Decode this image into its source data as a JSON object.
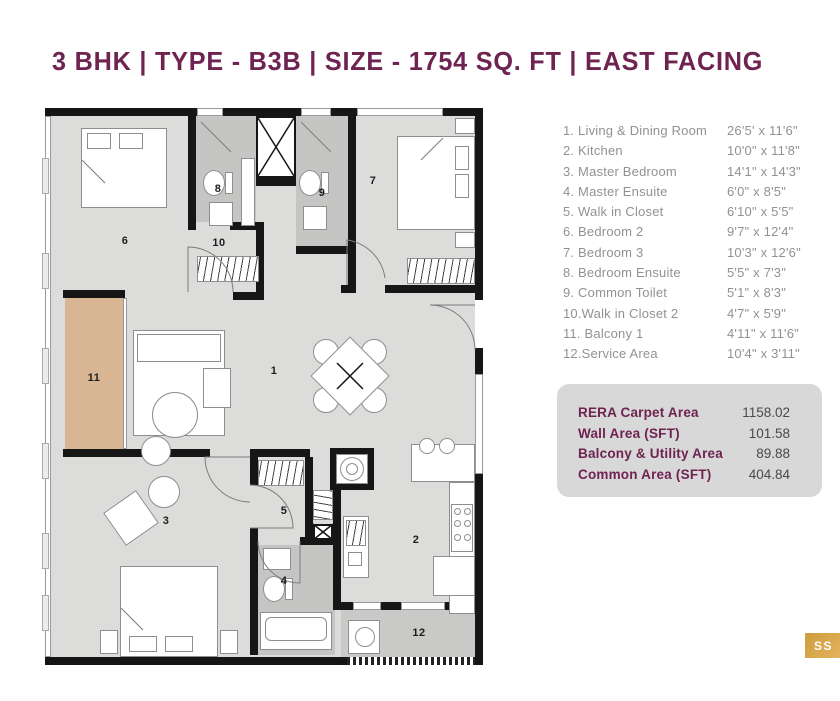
{
  "title": "3 BHK | TYPE - B3B | SIZE - 1754 SQ. FT | EAST FACING",
  "legend": {
    "items": [
      {
        "label": "1.  Living & Dining Room",
        "dim": "26'5' x 11'6\""
      },
      {
        "label": "2. Kitchen",
        "dim": "10'0\" x 11'8\""
      },
      {
        "label": "3. Master Bedroom",
        "dim": "14'1\" x 14'3\""
      },
      {
        "label": "4. Master Ensuite",
        "dim": "6'0\" x 8'5\""
      },
      {
        "label": "5. Walk in Closet",
        "dim": "6'10\" x 5'5\""
      },
      {
        "label": "6. Bedroom 2",
        "dim": "9'7\" x 12'4\""
      },
      {
        "label": "7. Bedroom 3",
        "dim": "10'3\" x 12'6\""
      },
      {
        "label": "8. Bedroom Ensuite",
        "dim": "5'5\" x 7'3\""
      },
      {
        "label": "9. Common Toilet",
        "dim": "5'1\" x 8'3\""
      },
      {
        "label": "10.Walk in Closet 2",
        "dim": "4'7\" x 5'9\""
      },
      {
        "label": "11. Balcony 1",
        "dim": "4'11\" x 11'6\""
      },
      {
        "label": "12.Service Area",
        "dim": "10'4\" x 3'11\""
      }
    ]
  },
  "area_summary": {
    "rows": [
      {
        "label": "RERA Carpet Area",
        "value": "1158.02"
      },
      {
        "label": "Wall Area (SFT)",
        "value": "101.58"
      },
      {
        "label": "Balcony & Utility Area",
        "value": "89.88"
      },
      {
        "label": "Common Area (SFT)",
        "value": "404.84"
      }
    ]
  },
  "watermark": "SS",
  "colors": {
    "accent": "#6e2351",
    "gold": "#d5a24b"
  },
  "floorplan": {
    "rooms": [
      {
        "n": "1",
        "x": 229,
        "y": 263
      },
      {
        "n": "2",
        "x": 371,
        "y": 432
      },
      {
        "n": "3",
        "x": 121,
        "y": 413
      },
      {
        "n": "4",
        "x": 239,
        "y": 473
      },
      {
        "n": "5",
        "x": 239,
        "y": 403
      },
      {
        "n": "6",
        "x": 80,
        "y": 133
      },
      {
        "n": "7",
        "x": 328,
        "y": 73
      },
      {
        "n": "8",
        "x": 173,
        "y": 81
      },
      {
        "n": "9",
        "x": 277,
        "y": 85
      },
      {
        "n": "10",
        "x": 174,
        "y": 135
      },
      {
        "n": "11",
        "x": 49,
        "y": 270
      },
      {
        "n": "12",
        "x": 374,
        "y": 525
      }
    ]
  }
}
